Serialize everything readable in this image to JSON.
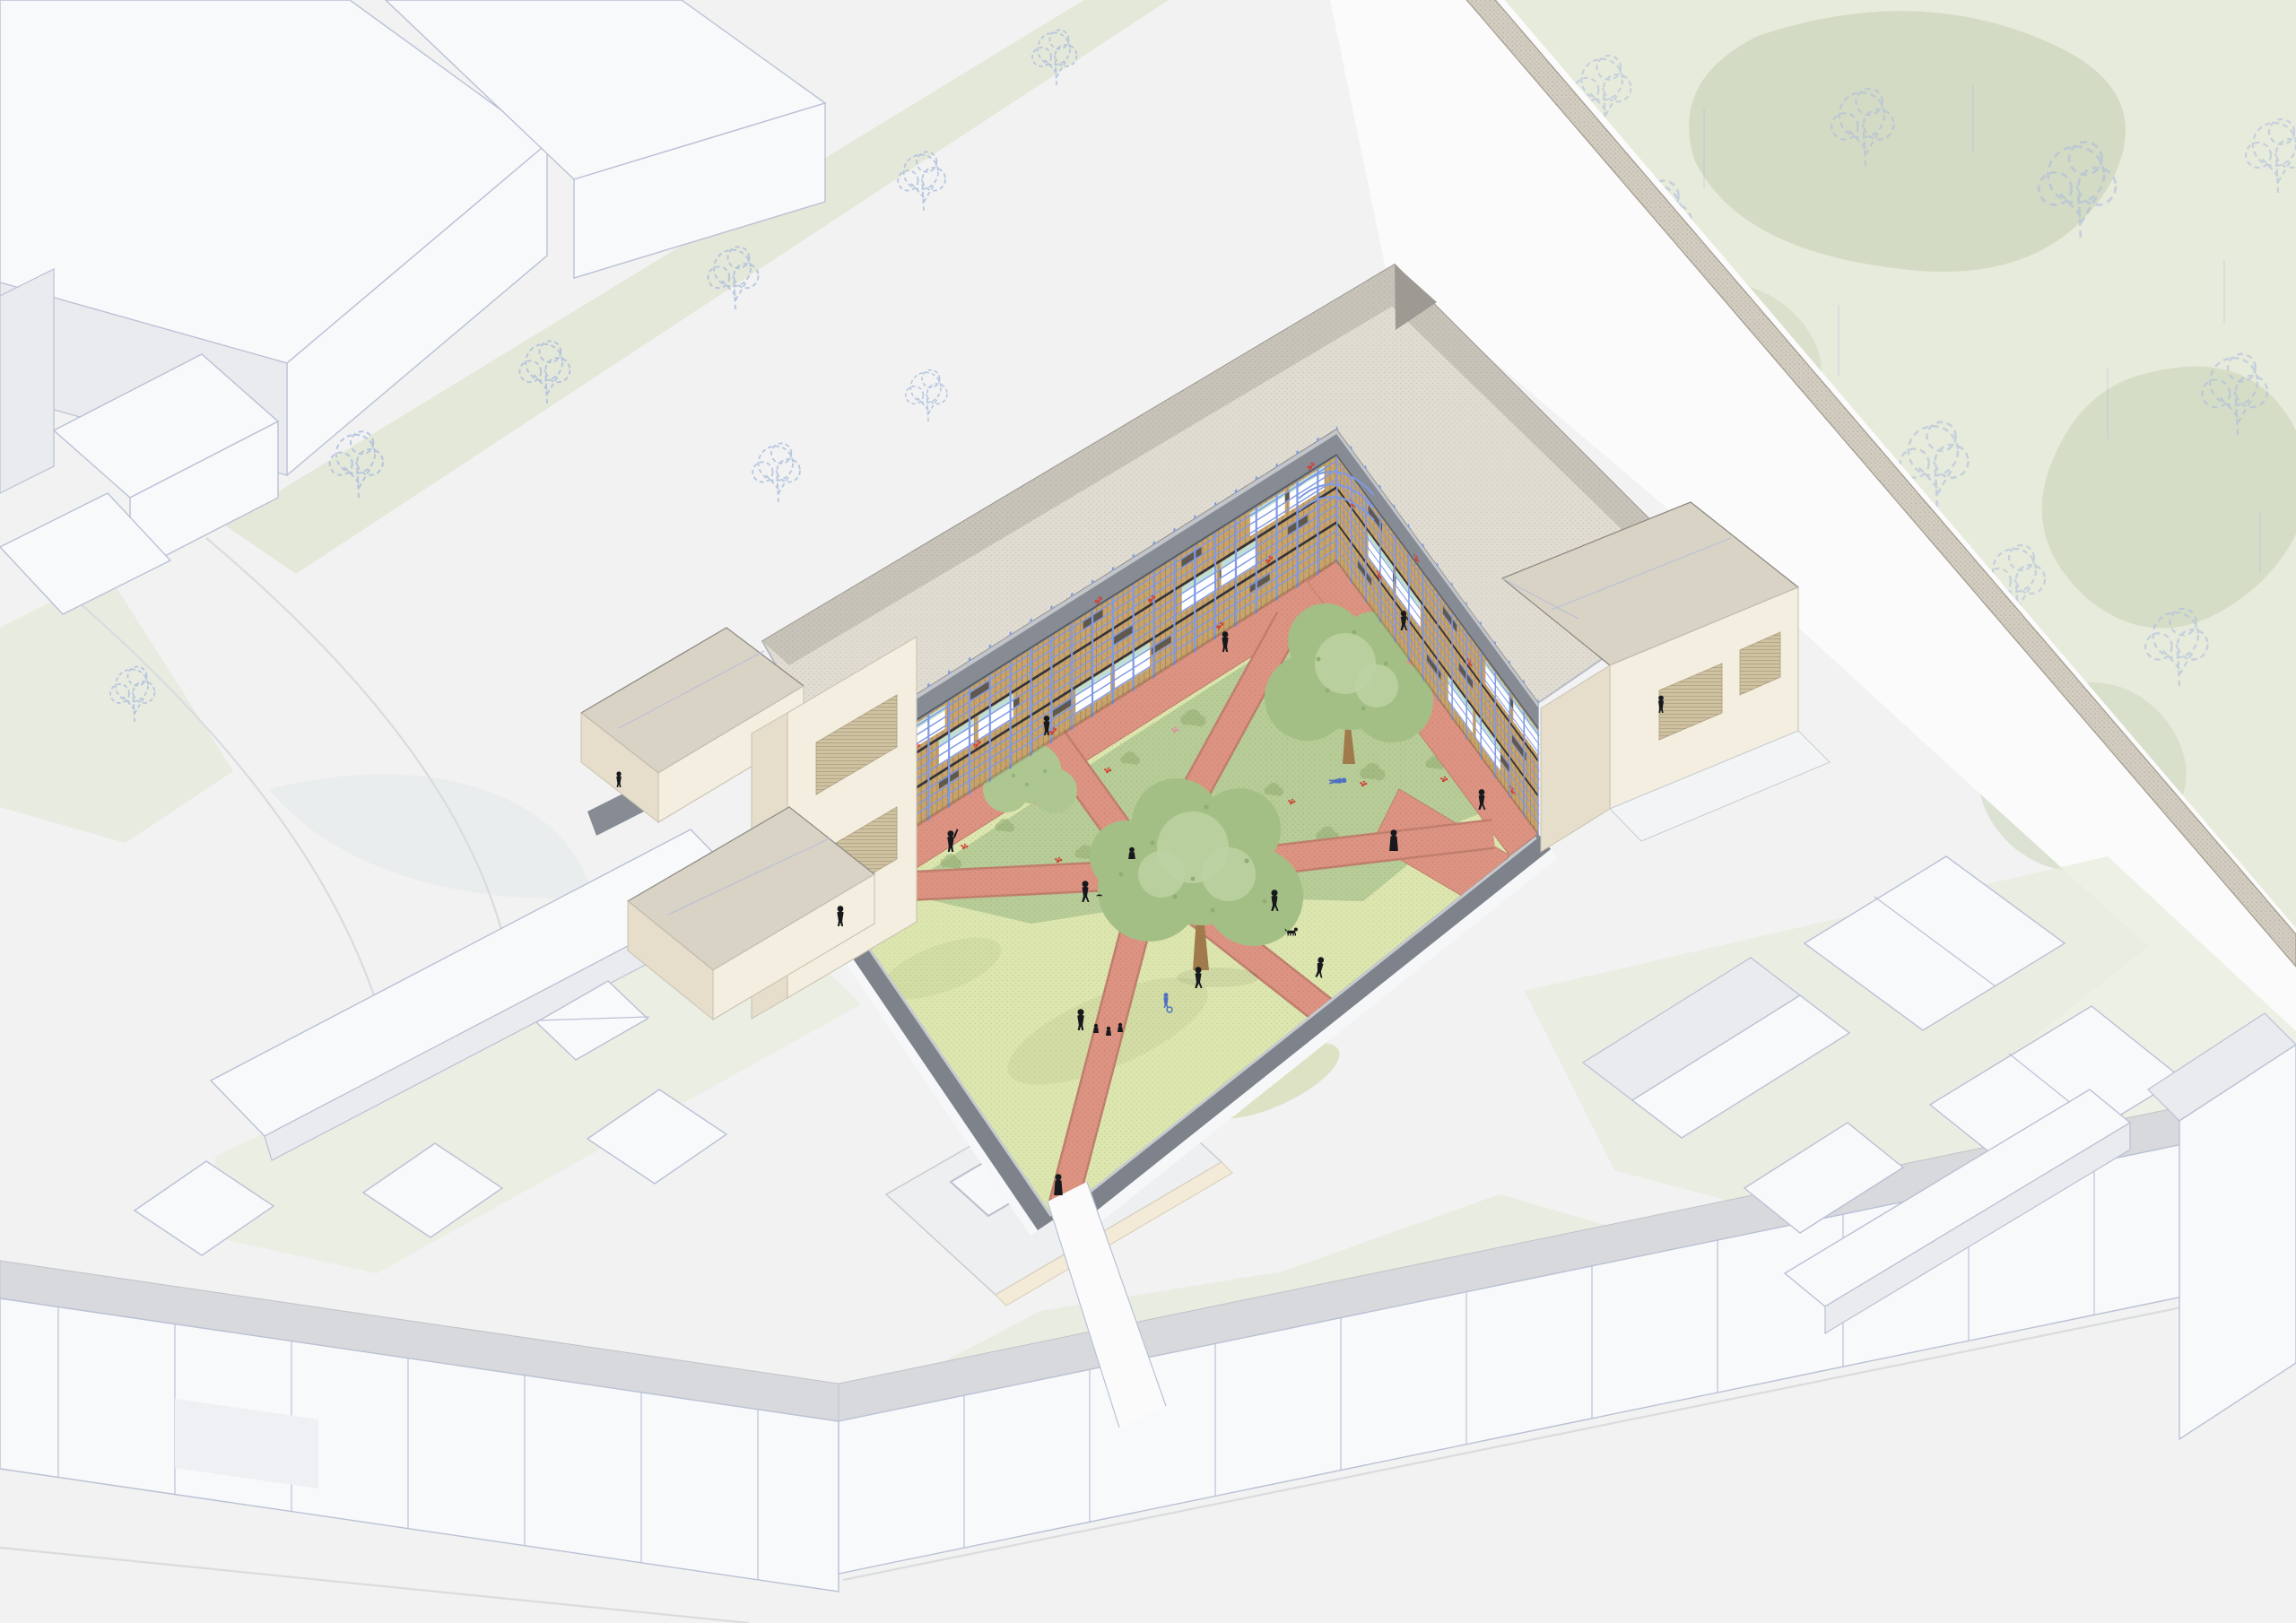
{
  "scene": {
    "label": "Axonometric aerial rendering of an L-shaped gallery-access housing block with blue balcony railings wrapping a landscaped courtyard; salmon paths radiate in a star from a central lawn with trees, surrounded by terraced houses, white city blocks and a walled park",
    "courtyard": {
      "ground": "stippled light yellow-green lawn",
      "paths": "salmon radial star with perimeter gallery walkways",
      "courtyard_trees": 3,
      "planted_beds": "textured green with red and pink flowers",
      "people": 20,
      "dogs": 1,
      "strollers": 1,
      "tricycles": 1
    },
    "building": {
      "wings": 2,
      "gallery_levels": 3,
      "facade": "timber-slat cladding",
      "railings": "periwinkle blue posts and rails",
      "flower_boxes": "red geraniums on white panels",
      "roof": "large beige hipped roof, dotted texture, dark grey parapet band",
      "corner_pavilions": "cream render with louvred windows and tan hipped roofs"
    },
    "surroundings": {
      "north_west": "white city blocks with sketched blue outline trees",
      "north_east": "walled park, pale sage green with sketched trees and brick boundary wall",
      "south": "rows of white terraced houses with grey roof bands",
      "south_east": "cluster of white gabled houses with pale green gardens",
      "south_west": "low flat-roofed hall with skylights and long white shed"
    }
  },
  "palette": {
    "bg": "#f1f2f1",
    "street": "#fafbfa",
    "curb": "#d9dcde",
    "block-white": "#f8f9fb",
    "block-shade": "#e9ebee",
    "block-outline": "#b9c1d4",
    "row-roof-gray": "#d7d9dc",
    "park-green": "#e7ebdb",
    "park-blob": "#cfd7bf",
    "verge-green": "#e4e8d9",
    "tree-outline-blue": "#a9bbdd",
    "wall-dark": "#7e838b",
    "wall-light": "#c7cbd0",
    "brick-wall": "#d3ccc0",
    "brick-edge": "#a59c90",
    "roof-beige": "#e0dcd2",
    "roof-beige-dark": "#c7c3b9",
    "roof-tan": "#d9d3c6",
    "roof-line": "#8f8b84",
    "cream": "#f4eee1",
    "cream-shade": "#e6ddcb",
    "louver": "#cfc2a0",
    "facade-tan": "#c9a46c",
    "rail-blue": "#7f99e4",
    "window-white": "#ffffff",
    "window-teal": "#bfdfd6",
    "flower-red": "#d23f33",
    "flower-pink": "#e28fa0",
    "parapet": "#878c94",
    "parapet-top": "#c2c6cb",
    "lawn": "#dce6ae",
    "lawn-patch": "#cbd69c",
    "bed-green": "#b7cc97",
    "bed-dark": "#93ac72",
    "canopy": "#a3bf85",
    "canopy-light": "#bdd2a2",
    "canopy-dark": "#8fae73",
    "trunk-brown": "#a07a4a",
    "path-salmon": "#dd9381",
    "path-salmon-dark": "#c17f6e",
    "person-black": "#17191d",
    "accent-blue-kid": "#4f6fc0",
    "fascia-cream": "#f3ead8"
  }
}
